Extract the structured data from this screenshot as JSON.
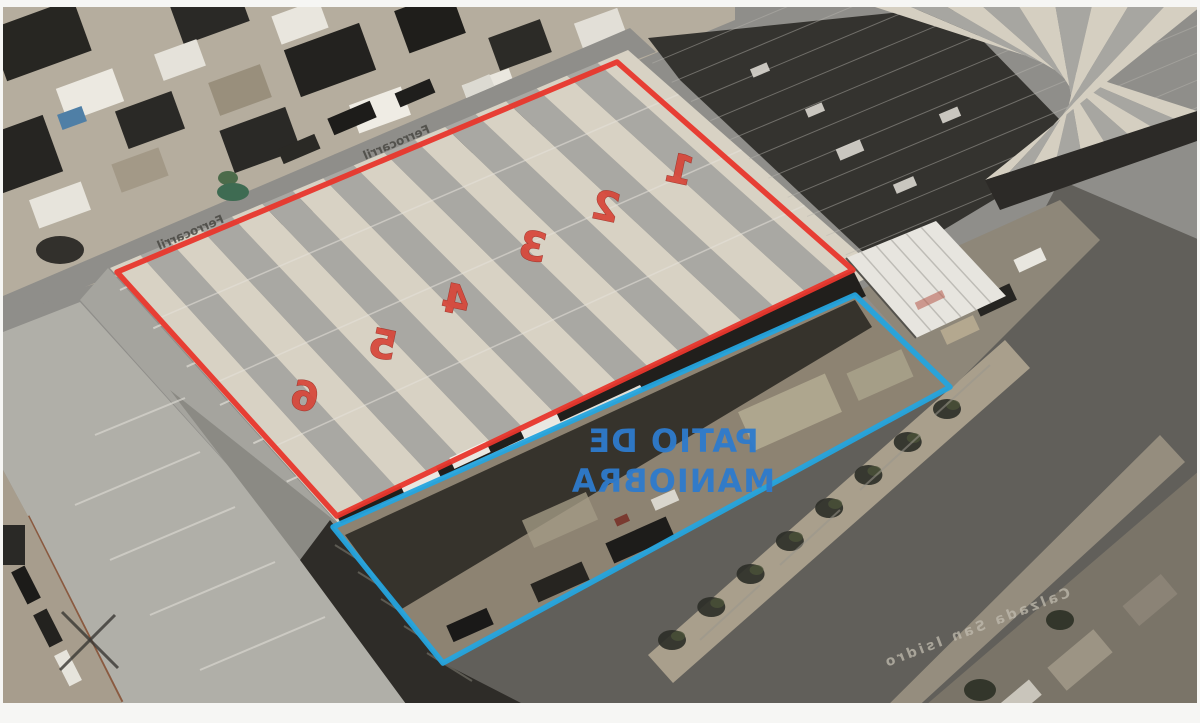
{
  "page": {
    "background": "#f6f6f4"
  },
  "annotations": {
    "building_outline_color": "#e8362c",
    "yard_outline_color": "#25a4de",
    "unit_numbers": [
      "1",
      "2",
      "3",
      "4",
      "5",
      "6"
    ],
    "unit_numbers_color": "#d7473a",
    "yard_label": {
      "line1": "PATIO DE",
      "line2": "MANIOBRA",
      "color": "#2e7bcd"
    },
    "street_labels": [
      "Ferrocarril",
      "Ferrocarril"
    ],
    "road_label": "Calzada San Isidro"
  }
}
